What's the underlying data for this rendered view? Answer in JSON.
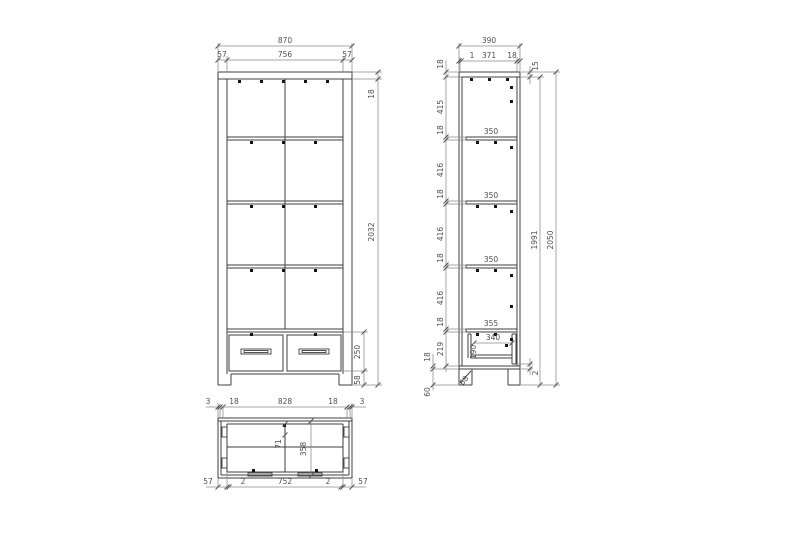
{
  "meta": {
    "background": "#ffffff",
    "object_line_color": "#3f3f3f",
    "dimension_line_color": "#8a8a8a",
    "text_color": "#4f4f4f",
    "mark_color": "#141414"
  },
  "front": {
    "w_total": "870",
    "w_left": "57",
    "w_mid": "756",
    "w_right": "57",
    "h_top": "18",
    "h_body": "2032",
    "h_drawer": "250",
    "h_plinth": "58"
  },
  "side": {
    "d_total": "390",
    "d_back": "1",
    "d_mid": "371",
    "d_front": "18",
    "top_detail": "15",
    "chain": [
      "18",
      "415",
      "18",
      "416",
      "18",
      "416",
      "18",
      "416",
      "18",
      "219"
    ],
    "bottom_panel": "18",
    "plinth": "60",
    "leg_cut": "68",
    "shelves": [
      "350",
      "350",
      "350",
      "355"
    ],
    "drawer_w": "340",
    "drawer_h": "190",
    "inner_height": "1991",
    "total_height": "2050",
    "front_gap": "2"
  },
  "plan": {
    "top": [
      "3",
      "18",
      "828",
      "18",
      "3"
    ],
    "bottom": [
      "57",
      "2",
      "752",
      "2",
      "57"
    ],
    "inner_a": "71",
    "inner_b": "358"
  }
}
